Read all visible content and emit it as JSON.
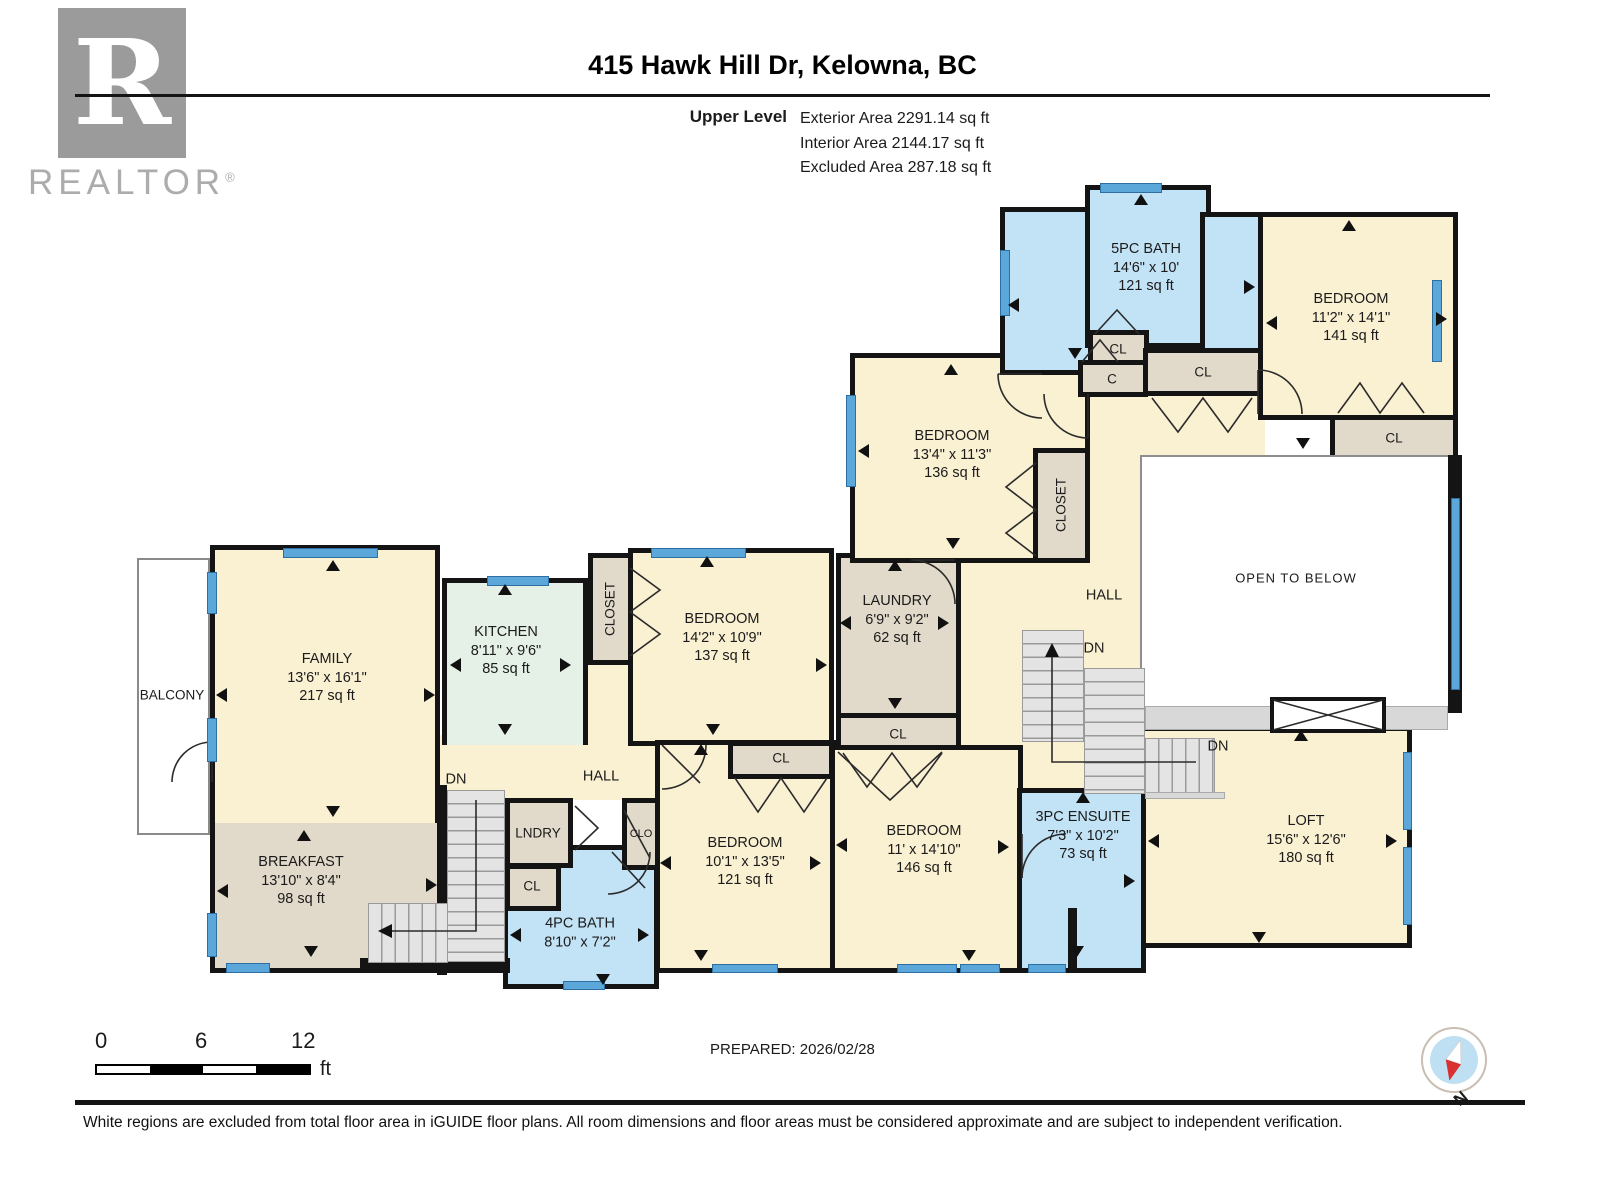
{
  "header": {
    "logo": {
      "letter": "R",
      "word": "REALTOR",
      "reg": "®"
    },
    "title": "415 Hawk Hill Dr, Kelowna, BC",
    "level_label": "Upper Level",
    "areas": [
      "Exterior Area 2291.14 sq ft",
      "Interior Area 2144.17 sq ft",
      "Excluded Area 287.18 sq ft"
    ]
  },
  "rooms": [
    {
      "name": "FAMILY",
      "dims": "13'6\" x 16'1\"",
      "area": "217 sq ft"
    },
    {
      "name": "KITCHEN",
      "dims": "8'11\" x 9'6\"",
      "area": "85 sq ft"
    },
    {
      "name": "BREAKFAST",
      "dims": "13'10\" x 8'4\"",
      "area": "98 sq ft"
    },
    {
      "name": "BEDROOM",
      "dims": "14'2\" x 10'9\"",
      "area": "137 sq ft"
    },
    {
      "name": "LAUNDRY",
      "dims": "6'9\" x 9'2\"",
      "area": "62 sq ft"
    },
    {
      "name": "BEDROOM",
      "dims": "13'4\" x 11'3\"",
      "area": "136 sq ft"
    },
    {
      "name": "5PC BATH",
      "dims": "14'6\" x 10'",
      "area": "121 sq ft"
    },
    {
      "name": "BEDROOM",
      "dims": "11'2\" x 14'1\"",
      "area": "141 sq ft"
    },
    {
      "name": "BEDROOM",
      "dims": "10'1\" x 13'5\"",
      "area": "121 sq ft"
    },
    {
      "name": "BEDROOM",
      "dims": "11' x 14'10\"",
      "area": "146 sq ft"
    },
    {
      "name": "3PC ENSUITE",
      "dims": "7'3\" x 10'2\"",
      "area": "73 sq ft"
    },
    {
      "name": "LOFT",
      "dims": "15'6\" x 12'6\"",
      "area": "180 sq ft"
    },
    {
      "name": "4PC BATH",
      "dims": "8'10\" x 7'2\""
    }
  ],
  "labels": {
    "balcony": "BALCONY",
    "hall": "HALL",
    "dn": "DN",
    "closet": "CLOSET",
    "cl": "CL",
    "c": "C",
    "clo": "CLO",
    "lndry": "LNDRY",
    "open_to_below": "OPEN TO BELOW"
  },
  "scale_bar": {
    "ticks": [
      "0",
      "6",
      "12"
    ],
    "unit": "ft"
  },
  "footer": {
    "prepared": "PREPARED: 2026/02/28",
    "disclaimer": "White regions are excluded from total floor area in iGUIDE floor plans. All room dimensions and floor areas must be considered approximate and are subject to independent verification.",
    "compass_n": "N"
  },
  "colors": {
    "wall": "#141414",
    "room_cream": "#FAF0D2",
    "room_blue": "#C2E2F6",
    "room_tan": "#E1D9C9",
    "room_mint": "#E5F0E7",
    "window_blue": "#5BA7D9",
    "stair_gray": "#E4E4E4",
    "ledge_gray": "#D8D8D8",
    "open_gray": "#8E8E8E",
    "logo_gray": "#9B9B9B",
    "compass_blue": "#BFE0F2",
    "compass_red": "#D93030"
  }
}
